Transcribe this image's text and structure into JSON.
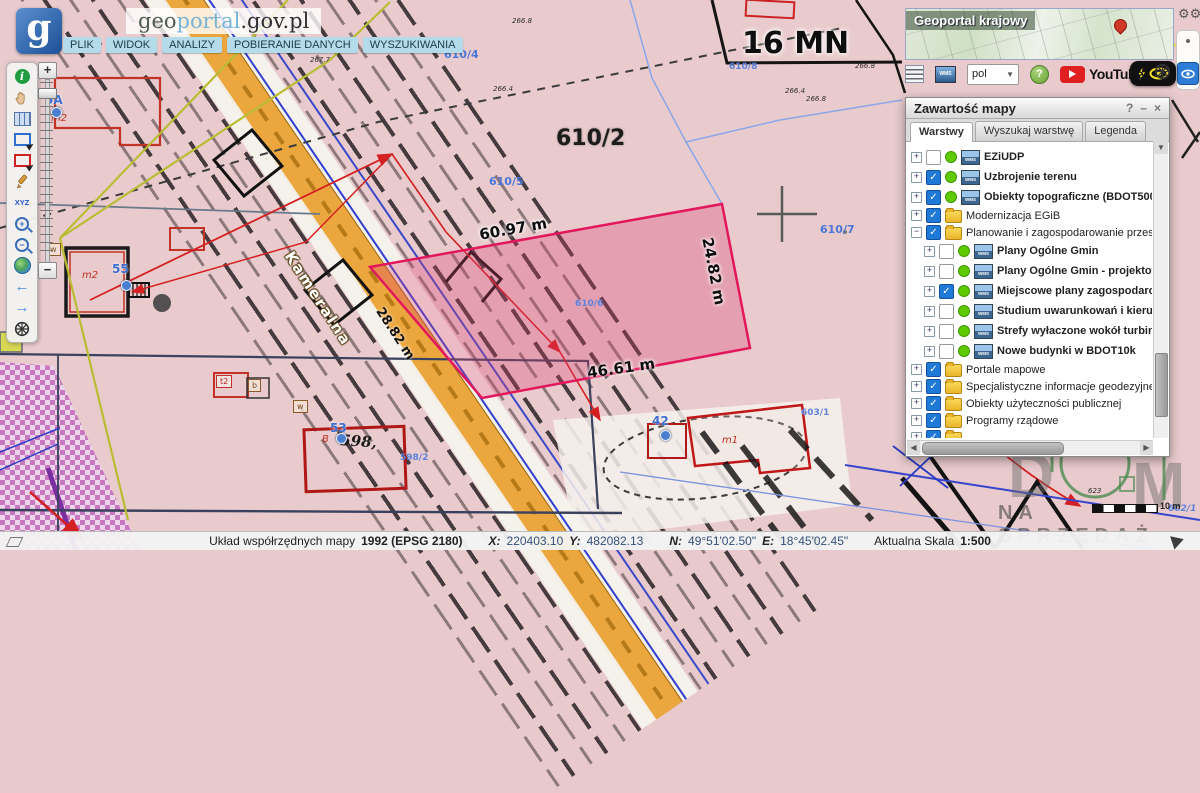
{
  "header": {
    "logo_letter": "g",
    "title_geo": "geo",
    "title_portal": "portal",
    "title_suffix": ".gov.pl",
    "menu": [
      {
        "label": "PLIK"
      },
      {
        "label": "WIDOK"
      },
      {
        "label": "ANALIZY"
      },
      {
        "label": "POBIERANIE DANYCH"
      },
      {
        "label": "WYSZUKIWANIA"
      }
    ]
  },
  "toolbar": {
    "xyz_label": "XYZ"
  },
  "overview_map": {
    "title": "Geoportal krajowy"
  },
  "quickbar": {
    "language": "pol",
    "youtube_label": "YouTube",
    "help_label": "?"
  },
  "layers_panel": {
    "title": "Zawartość mapy",
    "help_icon": "?",
    "minimize_icon": "–",
    "close_icon": "×",
    "tabs": [
      {
        "label": "Warstwy",
        "active": true
      },
      {
        "label": "Wyszukaj warstwę",
        "active": false
      },
      {
        "label": "Legenda",
        "active": false
      }
    ],
    "rows": [
      {
        "label": "EZiUDP",
        "type": "wms",
        "checked": false,
        "expander": "+",
        "indent": 0
      },
      {
        "label": "Uzbrojenie terenu",
        "type": "wms",
        "checked": true,
        "expander": "+",
        "indent": 0
      },
      {
        "label": "Obiekty topograficzne (BDOT500)",
        "type": "wms",
        "checked": true,
        "expander": "+",
        "indent": 0
      },
      {
        "label": "Modernizacja EGiB",
        "type": "folder",
        "checked": true,
        "expander": "+",
        "indent": 0
      },
      {
        "label": "Planowanie i zagospodarowanie przestrzenne",
        "type": "folder",
        "checked": true,
        "expander": "−",
        "indent": 0
      },
      {
        "label": "Plany Ogólne Gmin",
        "type": "wms",
        "checked": false,
        "expander": "+",
        "indent": 1
      },
      {
        "label": "Plany Ogólne Gmin - projektowane",
        "type": "wms",
        "checked": false,
        "expander": "+",
        "indent": 1
      },
      {
        "label": "Miejscowe plany zagospodarowania prz",
        "type": "wms",
        "checked": true,
        "expander": "+",
        "indent": 1
      },
      {
        "label": "Studium uwarunkowań i kierunków zag",
        "type": "wms",
        "checked": false,
        "expander": "+",
        "indent": 1
      },
      {
        "label": "Strefy wyłaczone wokół turbin wiatrow",
        "type": "wms",
        "checked": false,
        "expander": "+",
        "indent": 1
      },
      {
        "label": "Nowe budynki w BDOT10k",
        "type": "wms",
        "checked": false,
        "expander": "+",
        "indent": 1
      },
      {
        "label": "Portale mapowe",
        "type": "folder",
        "checked": true,
        "expander": "+",
        "indent": 0
      },
      {
        "label": "Specjalistyczne informacje geodezyjne",
        "type": "folder",
        "checked": true,
        "expander": "+",
        "indent": 0
      },
      {
        "label": "Obiekty użyteczności publicznej",
        "type": "folder",
        "checked": true,
        "expander": "+",
        "indent": 0
      },
      {
        "label": "Programy rządowe",
        "type": "folder",
        "checked": true,
        "expander": "+",
        "indent": 0
      },
      {
        "label": "",
        "type": "folder",
        "checked": true,
        "expander": "+",
        "indent": 0
      }
    ]
  },
  "map": {
    "highlighted_parcel": {
      "number": "610/6",
      "fill": "#db3e70",
      "stroke": "#e2175c"
    },
    "labels": [
      {
        "t": "610/4",
        "x": 444,
        "y": 48,
        "c": "pnum"
      },
      {
        "t": "267.7",
        "x": 310,
        "y": 56,
        "c": "elev"
      },
      {
        "t": "266.8",
        "x": 512,
        "y": 17,
        "c": "elev"
      },
      {
        "t": "266.4",
        "x": 493,
        "y": 85,
        "c": "elev"
      },
      {
        "t": "610/2",
        "x": 556,
        "y": 126,
        "c": "big"
      },
      {
        "t": "610/5",
        "x": 489,
        "y": 175,
        "c": "pnum"
      },
      {
        "t": "16 MN",
        "x": 742,
        "y": 26,
        "c": "zone"
      },
      {
        "t": "610/8",
        "x": 729,
        "y": 62,
        "c": "pnum-sm"
      },
      {
        "t": "266.4",
        "x": 785,
        "y": 87,
        "c": "elev"
      },
      {
        "t": "266.8",
        "x": 806,
        "y": 95,
        "c": "elev"
      },
      {
        "t": "266.8",
        "x": 855,
        "y": 62,
        "c": "elev"
      },
      {
        "t": "610/7",
        "x": 820,
        "y": 223,
        "c": "pnum"
      },
      {
        "t": "610/6",
        "x": 575,
        "y": 299,
        "c": "pnum-sm"
      },
      {
        "t": "60.97 m",
        "x": 478,
        "y": 226,
        "c": "measure",
        "r": -10
      },
      {
        "t": "24.82 m",
        "x": 716,
        "y": 236,
        "c": "measure",
        "r": 79
      },
      {
        "t": "46.61 m",
        "x": 586,
        "y": 364,
        "c": "measure",
        "r": -8
      },
      {
        "t": "28.82 m",
        "x": 385,
        "y": 305,
        "c": "measure-sm",
        "r": 57
      },
      {
        "t": "Kameralna",
        "x": 296,
        "y": 248,
        "c": "street",
        "r": 57
      },
      {
        "t": "5A",
        "x": 45,
        "y": 93,
        "c": "addr"
      },
      {
        "t": "m2",
        "x": 51,
        "y": 113,
        "c": "redit"
      },
      {
        "t": "55",
        "x": 112,
        "y": 262,
        "c": "addr"
      },
      {
        "t": "m2",
        "x": 82,
        "y": 270,
        "c": "redit"
      },
      {
        "t": "53",
        "x": 330,
        "y": 421,
        "c": "addr"
      },
      {
        "t": "B",
        "x": 322,
        "y": 434,
        "c": "redit"
      },
      {
        "t": "598,",
        "x": 341,
        "y": 431,
        "c": "hand",
        "r": 4
      },
      {
        "t": "598/2",
        "x": 400,
        "y": 453,
        "c": "pnum-sm"
      },
      {
        "t": "42",
        "x": 652,
        "y": 414,
        "c": "addr"
      },
      {
        "t": "m1",
        "x": 722,
        "y": 435,
        "c": "redit"
      },
      {
        "t": "603/1",
        "x": 801,
        "y": 408,
        "c": "pnum-sm"
      },
      {
        "t": "623",
        "x": 1088,
        "y": 487,
        "c": "elev"
      },
      {
        "t": "602/1",
        "x": 1168,
        "y": 504,
        "c": "blueit"
      },
      {
        "t": "w",
        "x": 46,
        "y": 243,
        "c": "boxed"
      },
      {
        "t": "t2",
        "x": 216,
        "y": 375,
        "c": "boxedr"
      },
      {
        "t": "b",
        "x": 248,
        "y": 379,
        "c": "boxed"
      },
      {
        "t": "w",
        "x": 293,
        "y": 400,
        "c": "boxed"
      }
    ],
    "address_dots": [
      [
        51,
        107
      ],
      [
        121,
        280
      ],
      [
        336,
        433
      ],
      [
        660,
        430
      ]
    ]
  },
  "watermark": {
    "d": "D",
    "m": "M",
    "text": "NA SPRZEDAŻ"
  },
  "scalebar": {
    "label": "10 m"
  },
  "statusbar": {
    "crs_label": "Układ współrzędnych mapy",
    "crs_value": "1992 (EPSG 2180)",
    "x_label": "X:",
    "x_value": "220403.10",
    "y_label": "Y:",
    "y_value": "482082.13",
    "n_label": "N:",
    "n_value": "49°51'02.50\"",
    "e_label": "E:",
    "e_value": "18°45'02.45\"",
    "scale_label": "Aktualna Skala",
    "scale_value": "1:500"
  }
}
